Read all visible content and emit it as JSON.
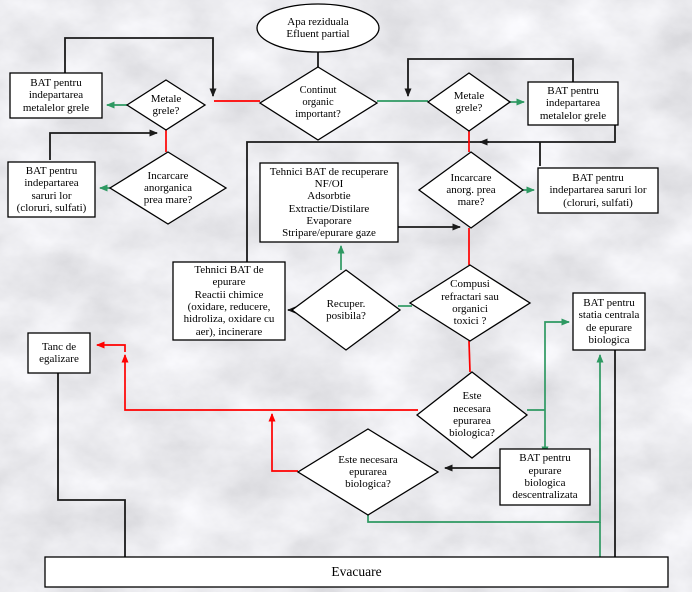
{
  "diagram_title": "Schema decizionala BAT pentru epurarea apelor reziduale",
  "colors": {
    "connector_black": "#1a1a1a",
    "connector_red": "#ff0000",
    "connector_green": "#2e9962",
    "node_fill": "#ffffff",
    "node_border": "#000000",
    "background_marble": "#dcdcdf"
  },
  "nodes": {
    "start": "Apa reziduala\nEfluent partial",
    "continut_organic": "Continut\norganic\nimportant?",
    "metale_grele_left": "Metale\ngrele?",
    "metale_grele_right": "Metale\ngrele?",
    "bat_metale_left": "BAT pentru\nindepartarea\nmetalelor grele",
    "bat_metale_right": "BAT pentru\nindepartarea\nmetalelor grele",
    "incarcare_left": "Incarcare\nanorganica\nprea mare?",
    "incarcare_right": "Incarcare\nanorg. prea\nmare?",
    "bat_saruri_left": "BAT pentru\nindepartarea\nsaruri lor\n(cloruri, sulfati)",
    "bat_saruri_right": "BAT pentru\nindepartarea saruri lor\n(cloruri, sulfati)",
    "tehnici_recuperare": "Tehnici BAT de recuperare\nNF/OI\nAdsorbtie\nExtractie/Distilare\nEvaporare\nStripare/epurare gaze",
    "recuper_posibila": "Recuper.\nposibila?",
    "tehnici_epurare": "Tehnici BAT de\nepurare\nReactii chimice\n(oxidare, reducere,\nhidroliza, oxidare cu\naer), incinerare",
    "compusi_refractari": "Compusi\nrefractari sau\norganici\ntoxici ?",
    "bat_statia_centrala": "BAT pentru\nstatia centrala\nde epurare\nbiologica",
    "este_necesara_1": "Este\nnecesara\nepurarea\nbiologica?",
    "este_necesara_2": "Este necesara\nepurarea\nbiologica?",
    "bat_descentralizata": "BAT pentru\nepurare\nbiologica\ndescentralizata",
    "tanc_egalizare": "Tanc de\negalizare",
    "evacuare": "Evacuare"
  }
}
